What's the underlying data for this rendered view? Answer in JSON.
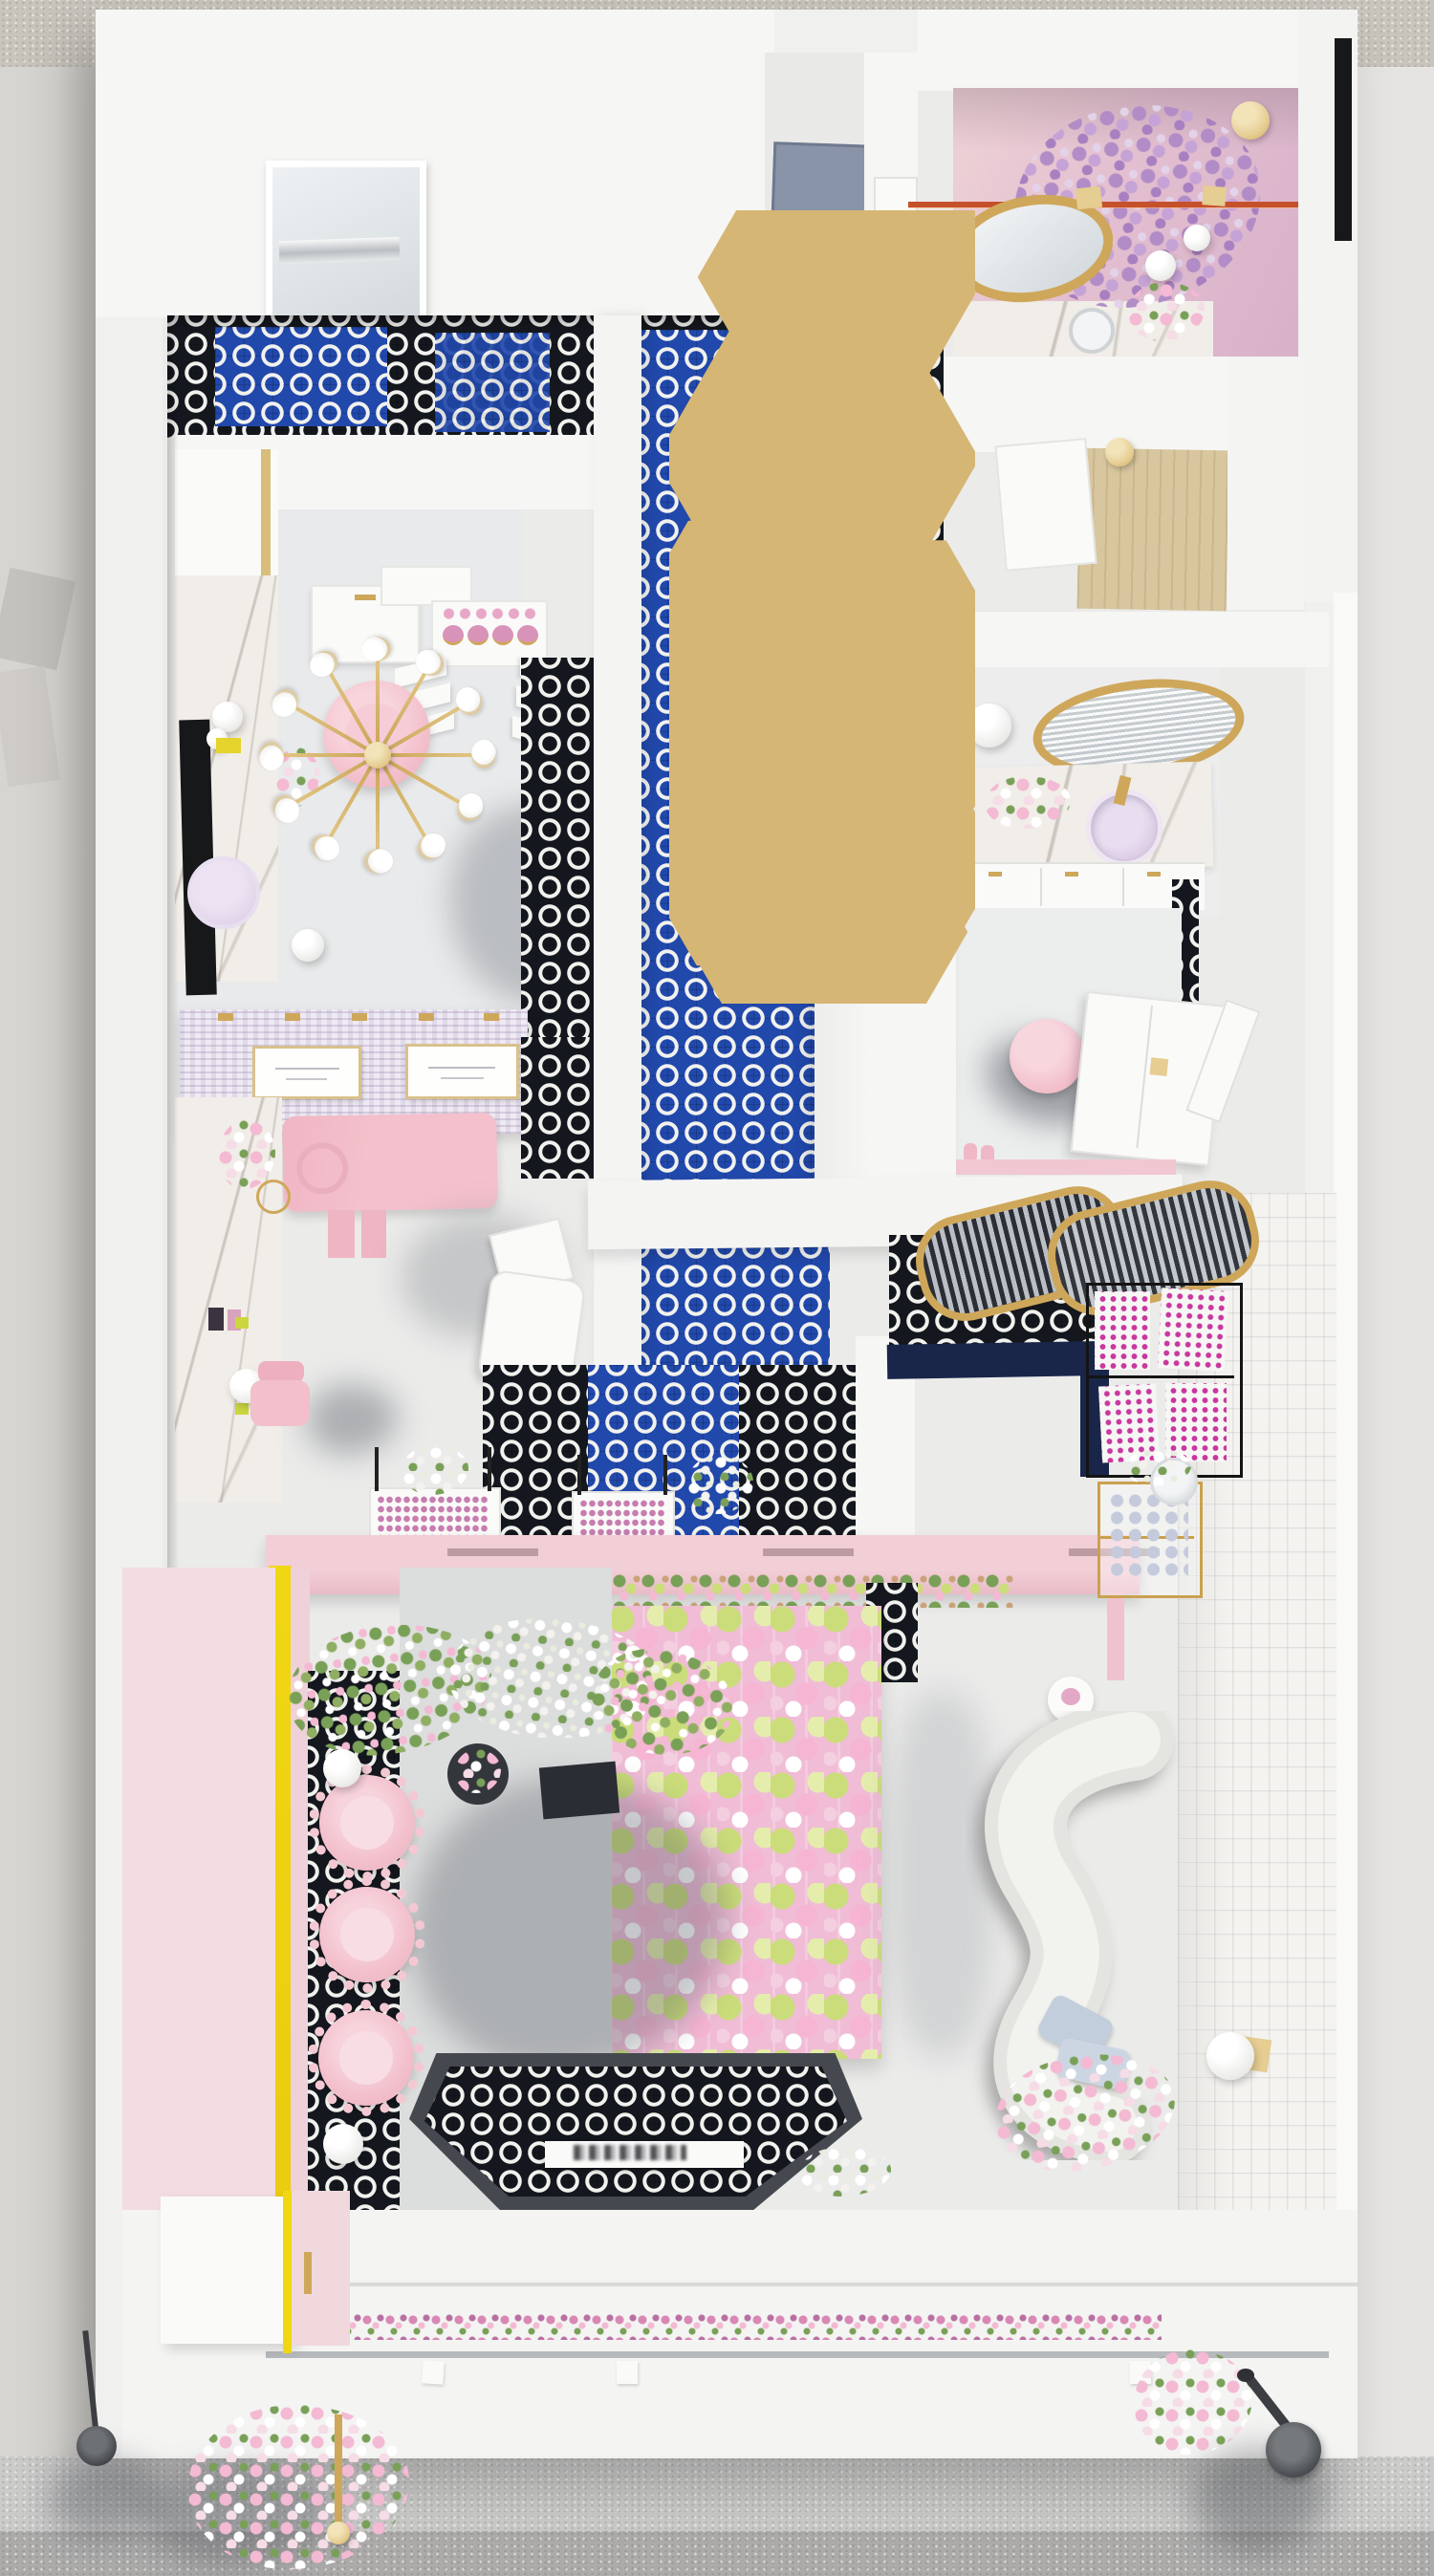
{
  "title": "Top-down 3D render of a pink beauty and nail salon interior",
  "colors": {
    "ground_top": "#c9c5bd",
    "ground_side": "#d7d5d1",
    "ground_right": "#e5e4e2",
    "sidewalk": "#cbcbca",
    "curb": "#acabaa",
    "building": "#f0f0ef",
    "wall": "#f6f6f5",
    "wall_bright": "#fafaf9",
    "floor": "#ebebea",
    "floor_gray": "#dcdddd",
    "room_floor": "#e9eaeb",
    "tile_black_base": "#14171d",
    "tile_blue_base": "#2148ab",
    "tile_ring": "#f1f1ee",
    "navy": "#19264a",
    "pink_chair": "#f2bfcb",
    "pink_bed": "#f3c0cb",
    "pink_table": "#f2ced6",
    "pink_wall": "#f3dde2",
    "pink_bath_a": "#eed2d6",
    "pink_bath_b": "#d8b1ca",
    "purple_wisteria": "#b18cc6",
    "lavender": "#d9c9e2",
    "gold": "#cfa75a",
    "gold_light": "#e6cd92",
    "yellow": "#f0d713",
    "lime": "#ccd63f",
    "wood": "#d8c69e",
    "marble": "#f1ede8",
    "brick": "#f4f3f0",
    "door_gray": "#8a94a8",
    "black": "#17181a",
    "dark_gray": "#45494f",
    "lamp_dark": "#3c3e41",
    "sofa": "#f0f0ed",
    "pillow": "#c3cedd",
    "flower_pink": "#f4b9d3",
    "flower_green": "#cbdd7a",
    "foliage": "#79a057",
    "magenta": "#c9379f",
    "orange_rod": "#c5512b",
    "blossom": "#f6dce6"
  },
  "scene": {
    "view": "top-down dollhouse render",
    "regions": [
      {
        "id": "sidewalk-top",
        "label": "sidewalk strip above building"
      },
      {
        "id": "street-left",
        "label": "ground left of building"
      },
      {
        "id": "street-right",
        "label": "ground right of building"
      },
      {
        "id": "sidewalk-bottom",
        "label": "sidewalk with street lamp and bouquets"
      },
      {
        "id": "powder-room",
        "label": "pink powder room with wisteria and gold oval mirror"
      },
      {
        "id": "top-corridor",
        "label": "corridor with gray door"
      },
      {
        "id": "storage-room",
        "label": "storage room with plywood floor"
      },
      {
        "id": "vanity-room",
        "label": "vanity room with round gold mirror, marble counter and lavender sink"
      },
      {
        "id": "dressing-nook",
        "label": "nook with pink round chair and white wardrobe"
      },
      {
        "id": "retail-corner",
        "label": "retail corner with arch mirrors, black polish shelf and gold cart"
      },
      {
        "id": "treatment-room",
        "label": "treatment room with sputnik chandelier and pink chair"
      },
      {
        "id": "lash-lounge",
        "label": "lash lounge with pink bed, screen divider and massage chair"
      },
      {
        "id": "manicure-bar",
        "label": "pink manicure bar with polish displays"
      },
      {
        "id": "flower-lounge",
        "label": "lounge with hanging flower wall and curved sofa"
      },
      {
        "id": "seating-row",
        "label": "row of scalloped pink armchairs under cherry tree"
      },
      {
        "id": "entry",
        "label": "entry with mosaic mat and reception desk"
      },
      {
        "id": "corridor",
        "label": "blue mosaic corridor with gold hexagon pendants"
      }
    ],
    "objects": [
      "sputnik-chandelier",
      "oval-gold-mirror",
      "round-gold-mirror",
      "arch-mirrors",
      "metal-display-shelf",
      "gold-bar-cart",
      "curved-sofa",
      "scalloped-armchairs",
      "cherry-blossom-tree",
      "flower-wall",
      "wisteria-canopy",
      "street-lamp",
      "flower-planter-row",
      "entry-mosaic-mat",
      "herringbone-screen",
      "lash-bed",
      "massage-chair",
      "marble-counters",
      "hexagon-pendants",
      "polish-displays",
      "brick-feature-wall",
      "window-mirror",
      "gray-door",
      "black-wall-bar",
      "yellow-accent-stripe"
    ]
  }
}
